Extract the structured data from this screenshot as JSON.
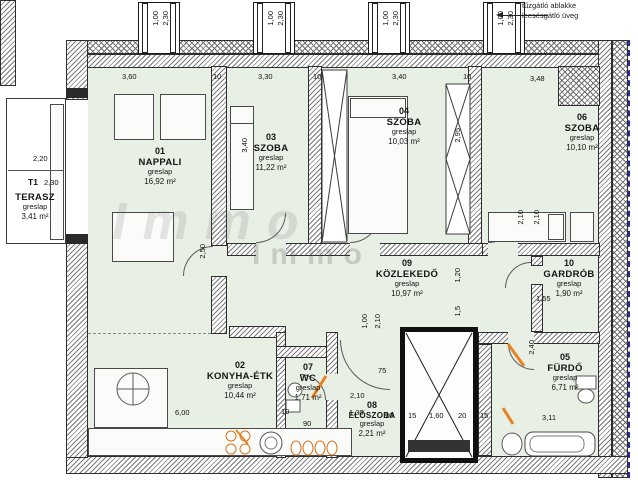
{
  "note": {
    "line1": "tűzgátló ablakke",
    "line2": "leesésgátló üveg"
  },
  "watermark": {
    "line1": "Immo",
    "line2": "Immo"
  },
  "window_label": {
    "width": "1,00",
    "height": "2,30"
  },
  "terrace": {
    "num": "T1",
    "name": "TERASZ",
    "mat": "greslap",
    "area": "3,41 m²"
  },
  "rooms": {
    "nappali": {
      "num": "01",
      "name": "NAPPALI",
      "mat": "greslap",
      "area": "16,92 m²"
    },
    "konyha": {
      "num": "02",
      "name": "KONYHA-ÉTK",
      "mat": "greslap",
      "area": "10,44 m²"
    },
    "szoba03": {
      "num": "03",
      "name": "SZOBA",
      "mat": "greslap",
      "area": "11,22 m²"
    },
    "szoba04": {
      "num": "04",
      "name": "SZOBA",
      "mat": "greslap",
      "area": "10,03 m²"
    },
    "furdo": {
      "num": "05",
      "name": "FÜRDŐ",
      "mat": "greslap",
      "area": "6,71 m²"
    },
    "szoba06": {
      "num": "06",
      "name": "SZOBA",
      "mat": "greslap",
      "area": "10,10 m²"
    },
    "wc": {
      "num": "07",
      "name": "WC",
      "mat": "greslap",
      "area": "1,71 m²"
    },
    "eloszoba": {
      "num": "08",
      "name": "ELŐSZOBA",
      "mat": "greslap",
      "area": "2,21 m²"
    },
    "kozlekedo": {
      "num": "09",
      "name": "KÖZLEKEDŐ",
      "mat": "greslap",
      "area": "10,97 m²"
    },
    "gardrob": {
      "num": "10",
      "name": "GARDRÓB",
      "mat": "greslap",
      "area": "1,90 m²"
    }
  },
  "dims": [
    "3,60",
    "10",
    "3,30",
    "10",
    "3,40",
    "10",
    "3,48",
    "2,20",
    "2,30",
    "3,40",
    "2,95",
    "2,50",
    "2,10",
    "2,10",
    "1,20",
    "1,5",
    "1,00",
    "2,10",
    "75",
    "10",
    "90",
    "2,10",
    "1,30",
    "20",
    "15",
    "1,60",
    "20",
    "15",
    "3,11",
    "6,00",
    "1,55",
    "2,40"
  ]
}
